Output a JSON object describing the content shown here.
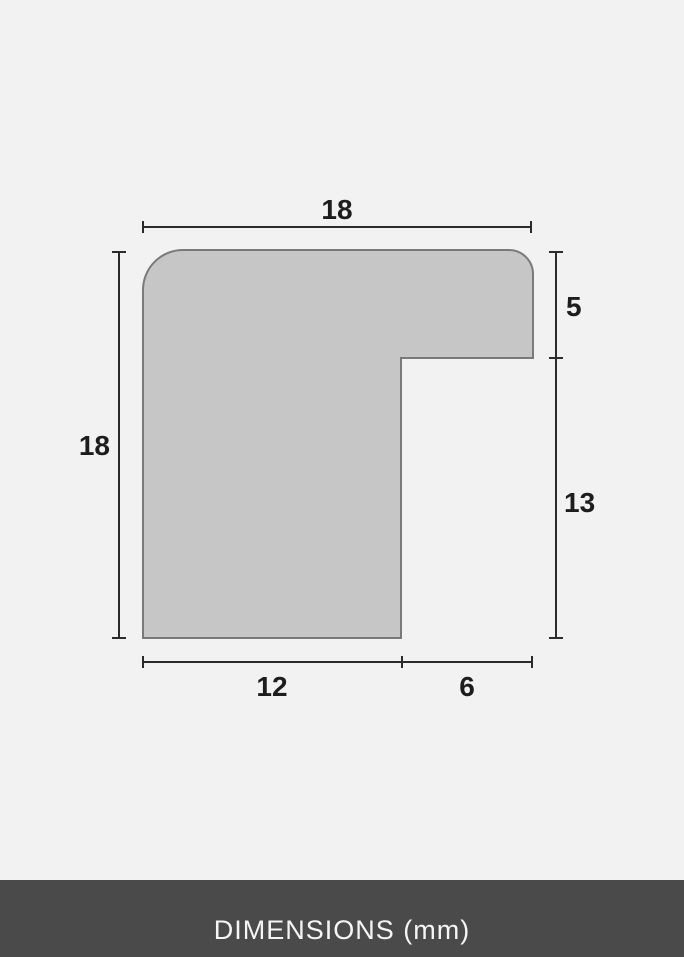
{
  "footer": {
    "label": "DIMENSIONS (mm)",
    "background": "#4a4a4a",
    "text_color": "#f5f5f5"
  },
  "diagram": {
    "description": "frame moulding profile cross-section",
    "unit": "mm",
    "colors": {
      "page_background": "#f1f2f1",
      "shape_fill": "#c6c6c6",
      "shape_stroke": "#7a7a7a",
      "dimension_line": "#2b2b2b",
      "label_text": "#1d1d1d"
    },
    "dimensions": {
      "top_width": "18",
      "left_height": "18",
      "right_upper": "5",
      "right_lower": "13",
      "bottom_left": "12",
      "bottom_right": "6"
    }
  }
}
